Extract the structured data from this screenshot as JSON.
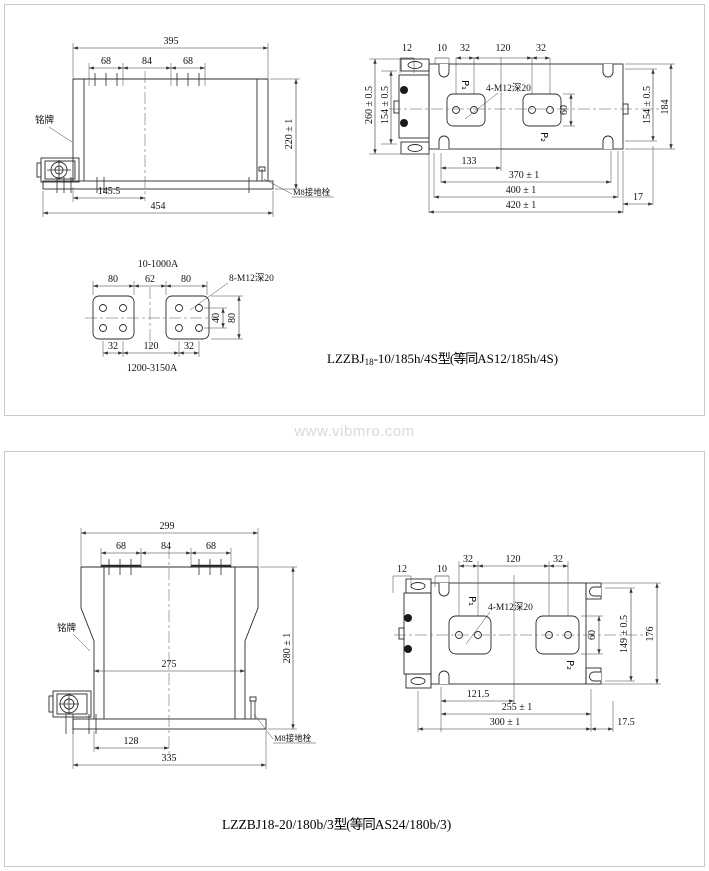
{
  "watermark": "www.vibmro.com",
  "panel1": {
    "caption": {
      "part1": "LZZBJ",
      "sub": "18",
      "part2": "-10/185h/4S",
      "cjk": "型(等同",
      "part3": "AS12/185h/4S)"
    },
    "front_view": {
      "dim_total_width": "395",
      "dim_left": "68",
      "dim_mid": "84",
      "dim_right": "68",
      "dim_height": "220 ± 1",
      "dim_center": "145.5",
      "dim_base": "454",
      "label_nameplate": "铭牌",
      "label_ground": "M8接地栓"
    },
    "top_view": {
      "dim_12": "12",
      "dim_10": "10",
      "dim_32a": "32",
      "dim_120": "120",
      "dim_32b": "32",
      "dim_outer_left": "260 ± 0.5",
      "dim_inner_left": "154 ± 0.5",
      "dim_inner_right": "154 ± 0.5",
      "dim_outer_right": "184",
      "label_p1": "P₁",
      "label_p2": "P₂",
      "dim_60": "60",
      "label_thread": "4-M12深20",
      "dim_133": "133",
      "dim_370": "370 ± 1",
      "dim_400": "400 ± 1",
      "dim_420": "420 ± 1",
      "dim_17": "17"
    },
    "terminal_detail": {
      "title": "10-1000A",
      "subtitle": "1200-3150A",
      "dim_80a": "80",
      "dim_62": "62",
      "dim_80b": "80",
      "label_thread": "8-M12深20",
      "dim_40": "40",
      "dim_80r": "80",
      "dim_32a": "32",
      "dim_120": "120",
      "dim_32b": "32"
    }
  },
  "panel2": {
    "caption": {
      "part1": "LZZBJ18-20/180b/3",
      "cjk": "型(等同",
      "part3": "AS24/180b/3)"
    },
    "front_view": {
      "dim_total_width": "299",
      "dim_left": "68",
      "dim_mid": "84",
      "dim_right": "68",
      "dim_height": "280 ± 1",
      "dim_body": "275",
      "dim_center": "128",
      "dim_base": "335",
      "label_nameplate": "铭牌",
      "label_ground": "M8接地栓"
    },
    "top_view": {
      "dim_12": "12",
      "dim_10": "10",
      "dim_32a": "32",
      "dim_120": "120",
      "dim_32b": "32",
      "dim_inner_right": "149 ± 0.5",
      "dim_outer_right": "176",
      "label_p1": "P₁",
      "label_p2": "P₂",
      "dim_60": "60",
      "label_thread": "4-M12深20",
      "dim_1215": "121.5",
      "dim_255": "255 ± 1",
      "dim_300": "300 ± 1",
      "dim_175": "17.5"
    }
  }
}
